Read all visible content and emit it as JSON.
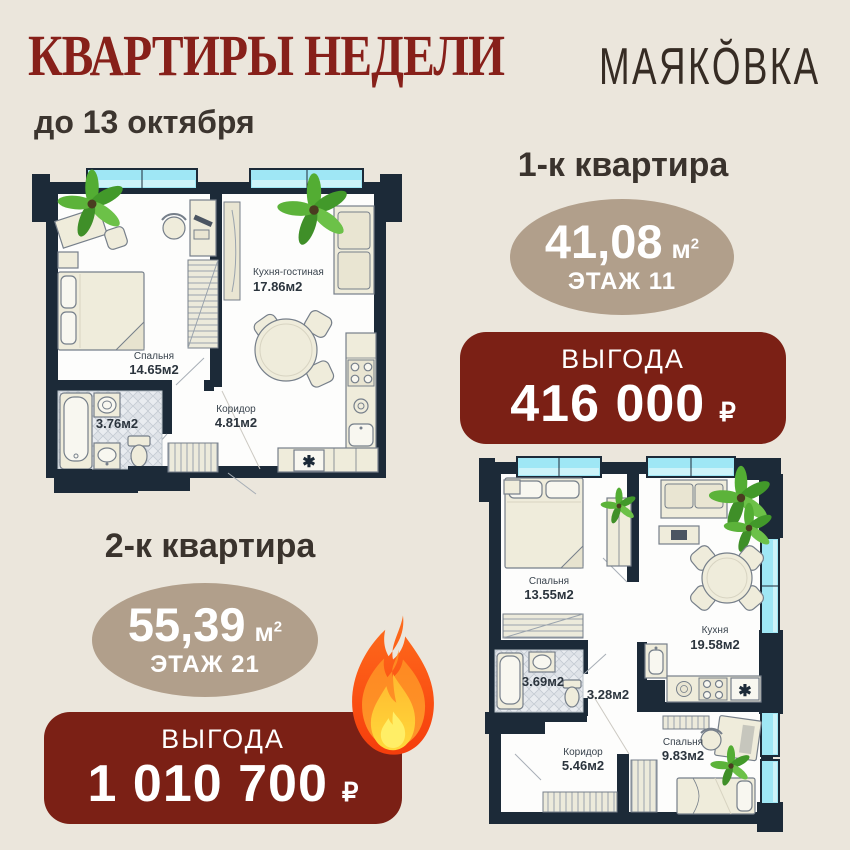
{
  "header": {
    "title": "КВАРТИРЫ НЕДЕЛИ",
    "brand": "МАЯКŎВКА",
    "deadline": "до 13 октября"
  },
  "offers": [
    {
      "heading": "1-к квартира",
      "area": "41,08",
      "unit": "м",
      "unit_sup": "2",
      "floor": "ЭТАЖ 11",
      "benefit_label": "ВЫГОДА",
      "benefit_value": "416 000",
      "currency": "₽"
    },
    {
      "heading": "2-к квартира",
      "area": "55,39",
      "unit": "м",
      "unit_sup": "2",
      "floor": "ЭТАЖ 21",
      "benefit_label": "ВЫГОДА",
      "benefit_value": "1 010 700",
      "currency": "₽"
    }
  ],
  "plan1": {
    "rooms": [
      {
        "name": "Кухня-гостиная",
        "area": "17.86м2"
      },
      {
        "name": "Спальня",
        "area": "14.65м2"
      },
      {
        "name": "",
        "area": "3.76м2"
      },
      {
        "name": "Коридор",
        "area": "4.81м2"
      }
    ],
    "washer_symbol": "✱"
  },
  "plan2": {
    "rooms": [
      {
        "name": "Спальня",
        "area": "13.55м2"
      },
      {
        "name": "Кухня",
        "area": "19.58м2"
      },
      {
        "name": "",
        "area": "3.69м2"
      },
      {
        "name": "",
        "area": "3.28м2"
      },
      {
        "name": "Коридор",
        "area": "5.46м2"
      },
      {
        "name": "Спальня",
        "area": "9.83м2"
      }
    ],
    "washer_symbol": "✱"
  },
  "colors": {
    "background": "#ebe6dc",
    "title_red": "#87201a",
    "badge_red": "#7b2015",
    "oval_tan": "#b19f8b",
    "wall_navy": "#1c2a38",
    "window_cyan": "#9fe7f5",
    "heading_dark": "#3a332d"
  }
}
